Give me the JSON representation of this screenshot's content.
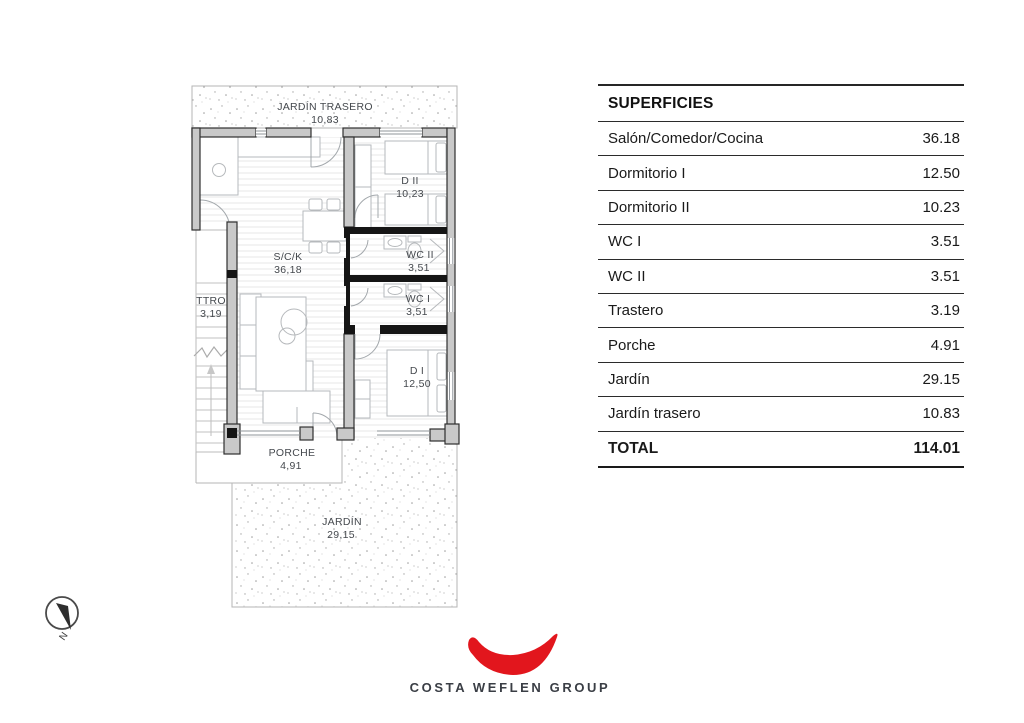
{
  "table": {
    "title": "SUPERFICIES",
    "rows": [
      {
        "label": "Salón/Comedor/Cocina",
        "value": "36.18"
      },
      {
        "label": "Dormitorio I",
        "value": "12.50"
      },
      {
        "label": "Dormitorio II",
        "value": "10.23"
      },
      {
        "label": "WC I",
        "value": "3.51"
      },
      {
        "label": "WC II",
        "value": "3.51"
      },
      {
        "label": "Trastero",
        "value": "3.19"
      },
      {
        "label": "Porche",
        "value": "4.91"
      },
      {
        "label": "Jardín",
        "value": "29.15"
      },
      {
        "label": "Jardín trasero",
        "value": "10.83"
      }
    ],
    "total": {
      "label": "TOTAL",
      "value": "114.01"
    }
  },
  "plan": {
    "rooms": [
      {
        "name": "JARDÍN TRASERO",
        "area": "10,83"
      },
      {
        "name": "D II",
        "area": "10,23"
      },
      {
        "name": "S/C/K",
        "area": "36,18"
      },
      {
        "name": "WC II",
        "area": "3,51"
      },
      {
        "name": "WC I",
        "area": "3,51"
      },
      {
        "name": "TTRO",
        "area": "3,19"
      },
      {
        "name": "D I",
        "area": "12,50"
      },
      {
        "name": "PORCHE",
        "area": "4,91"
      },
      {
        "name": "JARDÍN",
        "area": "29,15"
      }
    ],
    "compass_label": "N"
  },
  "logo": {
    "text": "COSTA WEFLEN GROUP"
  },
  "colors": {
    "accent_red": "#e2161d",
    "wall_gray": "#c9c9c9",
    "line_dark": "#2f2f2f",
    "logo_text": "#3a3e45"
  }
}
